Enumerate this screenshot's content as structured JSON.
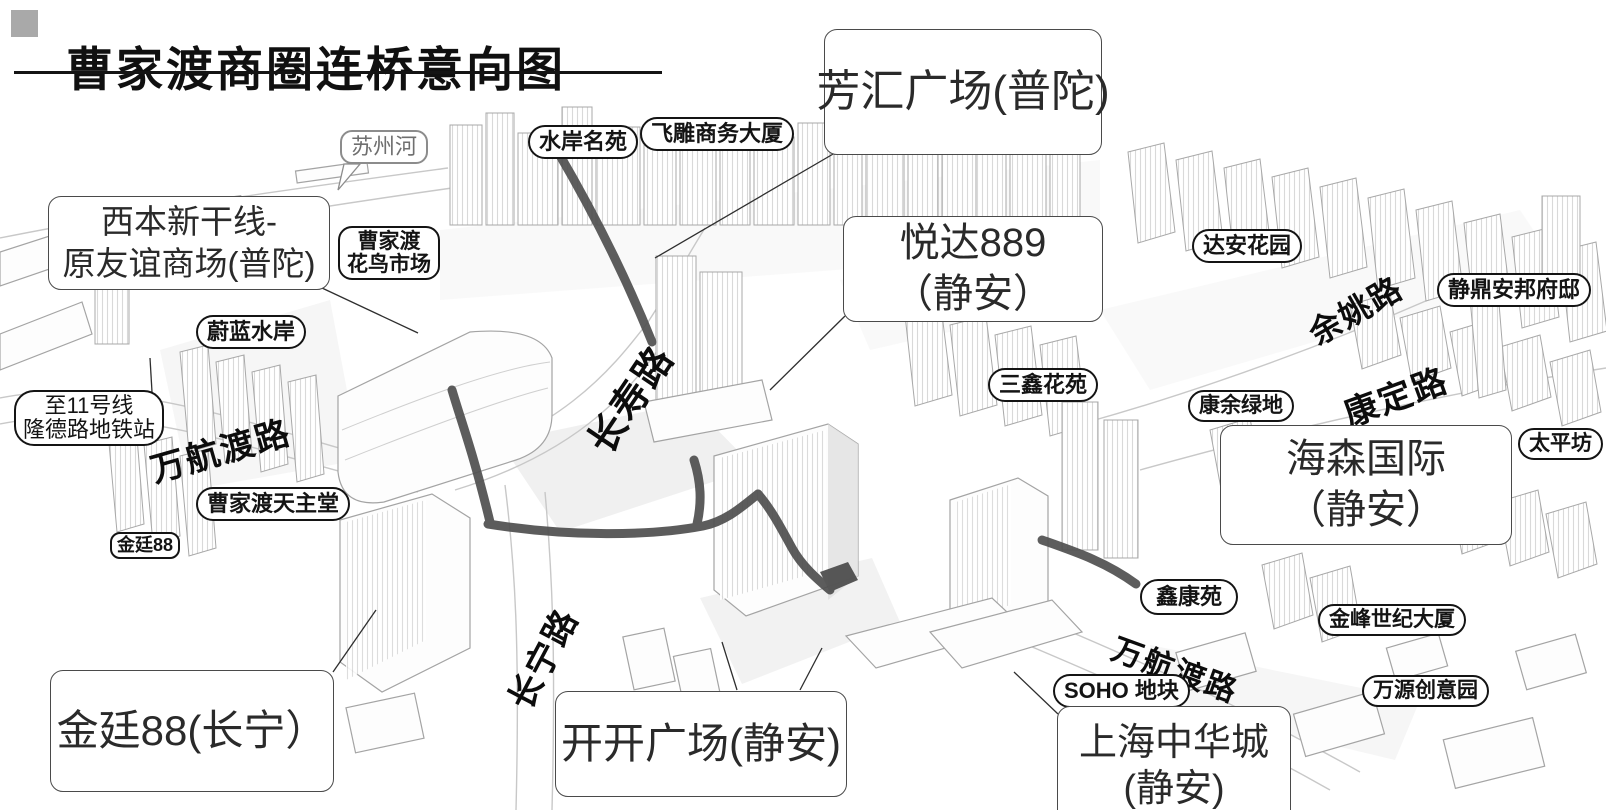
{
  "title": "曹家渡商圈连桥意向图",
  "callouts": {
    "fanghui": "芳汇广场(普陀)",
    "xiben1": "西本新干线-",
    "xiben2": "原友谊商场(普陀)",
    "yueda1": "悦达889",
    "yueda2": "（静安）",
    "haisen1": "海森国际",
    "haisen2": "（静安）",
    "jinting88": "金廷88(长宁）",
    "kaikai": "开开广场(静安)",
    "zhonghua1": "上海中华城",
    "zhonghua2": "(静安)"
  },
  "pills": {
    "suzhouhe": "苏州河",
    "shuian": "水岸名苑",
    "feidiao": "飞雕商务大厦",
    "huaniao1": "曹家渡",
    "huaniao2": "花鸟市场",
    "weilan": "蔚蓝水岸",
    "daan": "达安花园",
    "jingding": "静鼎安邦府邸",
    "sanxin": "三鑫花苑",
    "kangyu": "康余绿地",
    "taiping": "太平坊",
    "metro1": "至11号线",
    "metro2": "隆德路地铁站",
    "tianzhutang": "曹家渡天主堂",
    "jinting_small": "金廷88",
    "xinkang": "鑫康苑",
    "jinfeng": "金峰世纪大厦",
    "soho": "SOHO 地块",
    "wanyuan": "万源创意园"
  },
  "roads": {
    "wanhangdu_nw": "万航渡路",
    "changshou": "长寿路",
    "changning": "长宁路",
    "yuyao": "余姚路",
    "kangding": "康定路",
    "wanhangdu_se": "万航渡路"
  },
  "colors": {
    "bridge": "#4f4f4f",
    "label_border": "#141414",
    "title_bullet": "#a9a9a9"
  }
}
